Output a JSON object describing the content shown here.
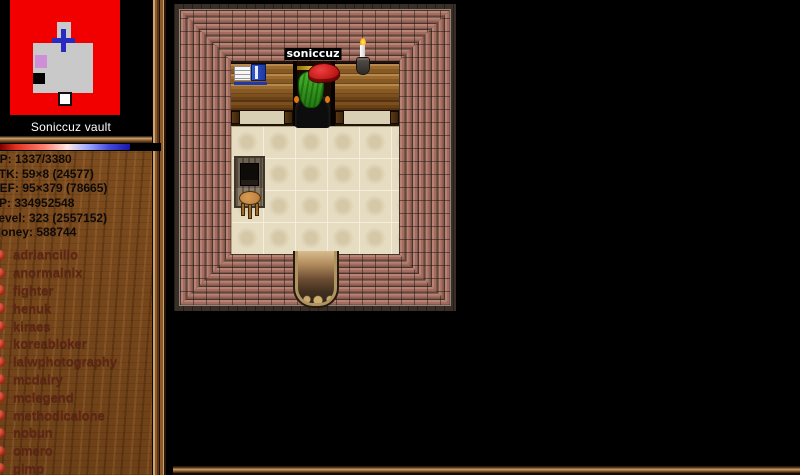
{
  "minimap": {
    "title": "Soniccuz vault"
  },
  "stats": [
    "HP: 1337/3380",
    "ATK: 59×8 (24577)",
    "DEF: 95×379 (78665)",
    "XP: 334952548",
    "Level: 323 (2557152)",
    "Money: 588744"
  ],
  "players": [
    "adriancillo",
    "anormalnix",
    "fighter",
    "henuk",
    "kiraes",
    "koreabloker",
    "lalwphotography",
    "mcdairy",
    "mclegend",
    "methodicalone",
    "nobun",
    "omero",
    "pimp"
  ],
  "game": {
    "character_name": "soniccuz"
  },
  "colors": {
    "minimap_red": "#f20000",
    "minimap_room_gray": "#c9c9c9",
    "minimap_marker_pink": "#cf8fd6",
    "minimap_cross_blue": "#2a2ac0",
    "player_dot_red": "#b02818",
    "hp_gradient_left": "#7a0000",
    "hp_gradient_right": "#1818a8",
    "brick": "#a26d60",
    "floor_tile": "#e6dcc2",
    "sidebar_wood": "#7b4a1e"
  }
}
